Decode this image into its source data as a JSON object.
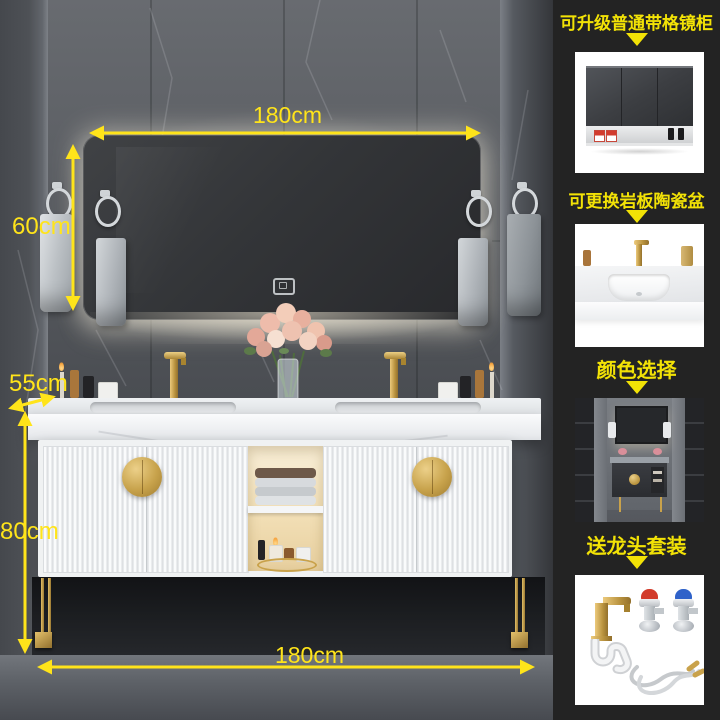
{
  "photo": {
    "annotations": {
      "top_width": "180cm",
      "mirror_height": "60cm",
      "counter_depth": "55cm",
      "cabinet_height": "80cm",
      "bottom_width": "180cm"
    }
  },
  "sidebar": {
    "sections": [
      {
        "title": "可升级普通带格镜柜"
      },
      {
        "title": "可更换岩板陶瓷盆"
      },
      {
        "title": "颜色选择"
      },
      {
        "title": "送龙头套装"
      }
    ]
  },
  "icons": {
    "down_arrow": "down-arrow-icon"
  },
  "colors": {
    "annotation_yellow": "#f2e206",
    "dimension_yellow": "#ffe41a",
    "sidebar_background": "#232323",
    "gold_accent": "#c9a24b"
  }
}
